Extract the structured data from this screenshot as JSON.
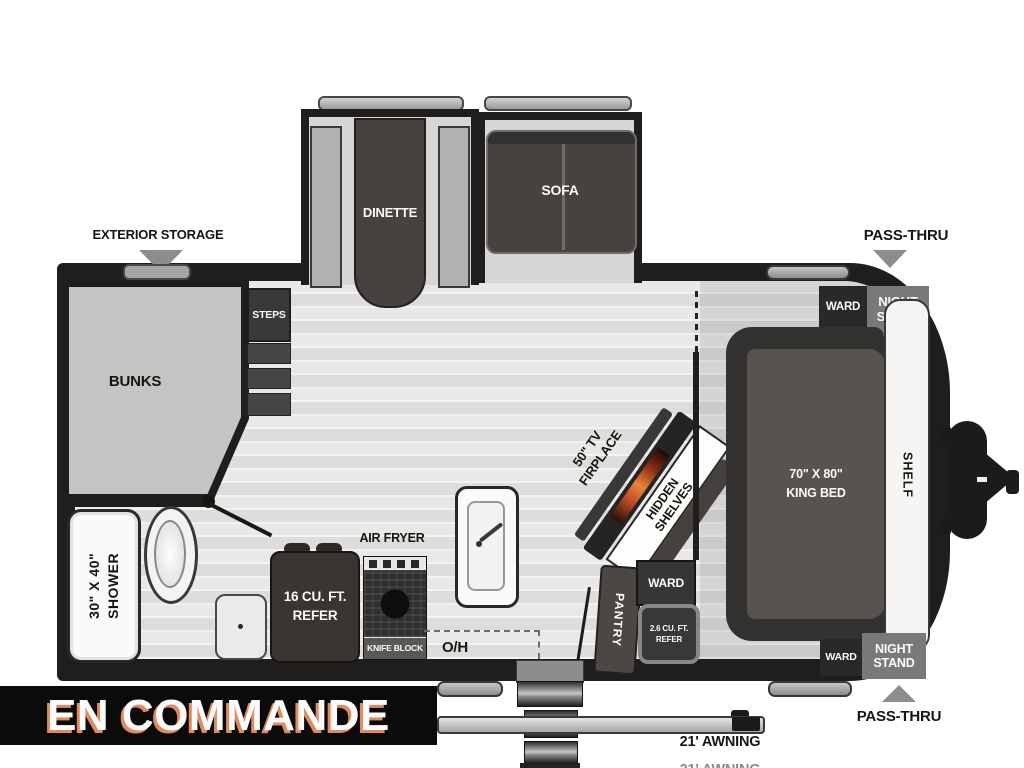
{
  "banner": {
    "label": "EN COMMANDE"
  },
  "exterior": {
    "storage": "EXTERIOR STORAGE",
    "pass_thru_top": "PASS-THRU",
    "pass_thru_bottom": "PASS-THRU",
    "awning": "21' AWNING"
  },
  "living": {
    "dinette": "DINETTE",
    "sofa": "SOFA",
    "steps": "STEPS",
    "bunks": "BUNKS",
    "tv_fireplace": "50\" TV\nFIRPLACE",
    "hidden_shelves": "HIDDEN\nSHELVES"
  },
  "bathroom": {
    "shower": "30\" X 40\"\nSHOWER"
  },
  "kitchen": {
    "air_fryer": "AIR FRYER",
    "refer": "16 CU. FT.\nREFER",
    "knife_block": "KNIFE BLOCK",
    "overhead": "O/H",
    "pantry": "PANTRY",
    "ward": "WARD",
    "mini_refer": "2.6 CU. FT.\nREFER"
  },
  "bedroom": {
    "ward_top": "WARD",
    "nightstand_top": "NIGHT\nSTAND",
    "king_bed": "70\" X 80\"\nKING BED",
    "shelf": "SHELF",
    "ward_bottom": "WARD",
    "nightstand_bottom": "NIGHT\nSTAND"
  },
  "colors": {
    "wall": "#201e1c",
    "floor_light": "#e9e8e6",
    "furniture_dark": "#454240",
    "gray_box": "#7b7977",
    "banner_bg": "#0b0b0b",
    "banner_text": "#fbfbfb",
    "banner_shadow": "#e28a5f",
    "flame_accent": "#e8833c"
  }
}
